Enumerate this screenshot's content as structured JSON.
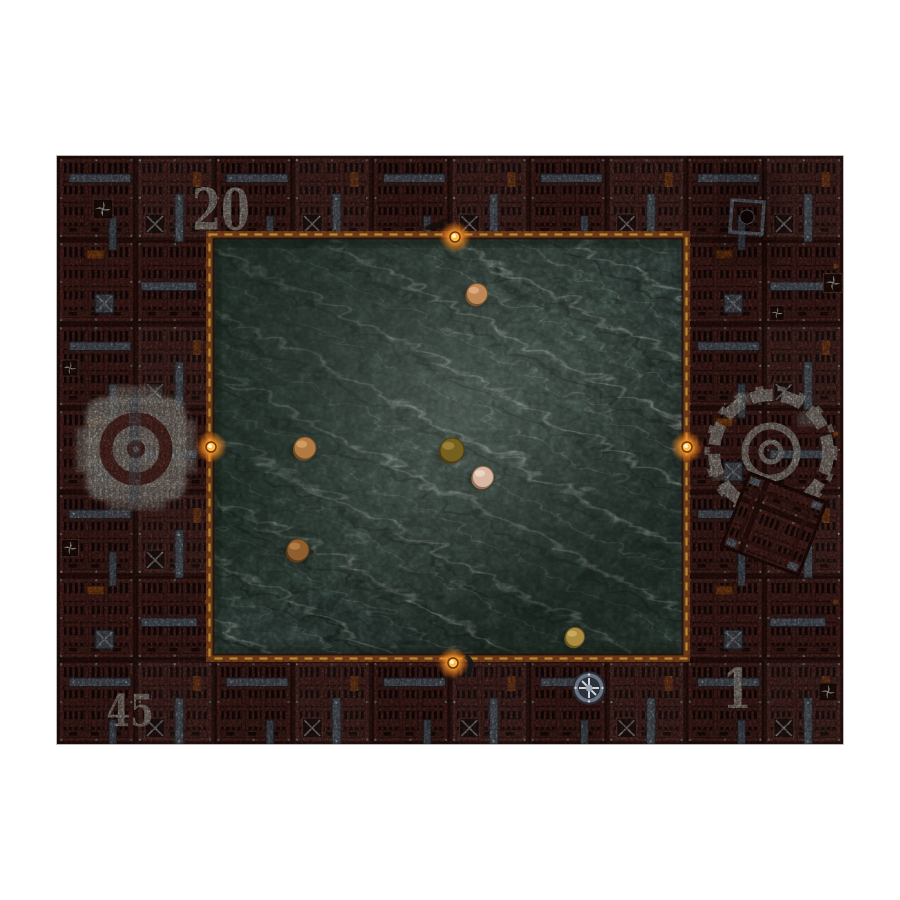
{
  "image": {
    "description": "Top-down product photo of an industrial sci-fi wargaming mat: rust-red grated deck border surrounding a murky teal water pool with round metal disc markers",
    "background_color": "#ffffff"
  },
  "mat": {
    "border": {
      "base_color": "#6d342d",
      "slot_color": "#241010",
      "frame_color": "#3a1713",
      "strap_color": "#8691a0",
      "accent_orange": "#c06320",
      "stencil_color": "#e9e4d8"
    },
    "zone_labels": {
      "top_left": "20",
      "bottom_left": "45",
      "bottom_right": "1"
    }
  },
  "water": {
    "base_color": "#56706a",
    "dark_color": "#37493f",
    "streak_color": "#dfe9df",
    "trim_color": "#6f3a18",
    "hazard_dash_color": "#c89d38"
  },
  "lamps": [
    {
      "name": "hazard-lamp",
      "x": 455,
      "y": 237
    },
    {
      "name": "hazard-lamp",
      "x": 211,
      "y": 447
    },
    {
      "name": "hazard-lamp",
      "x": 687,
      "y": 447
    },
    {
      "name": "hazard-lamp",
      "x": 453,
      "y": 663
    }
  ],
  "coins": [
    {
      "name": "coin-marker",
      "x": 477,
      "y": 294,
      "r": 10.5,
      "face": "#bd8856",
      "hi": "#e3b488",
      "rim": "#7a5230"
    },
    {
      "name": "coin-marker",
      "x": 305,
      "y": 448,
      "r": 11,
      "face": "#b07a42",
      "hi": "#d9a86b",
      "rim": "#6f4a24"
    },
    {
      "name": "coin-marker",
      "x": 452,
      "y": 450,
      "r": 12,
      "face": "#75601f",
      "hi": "#a58a42",
      "rim": "#4f3c14"
    },
    {
      "name": "coin-marker",
      "x": 483,
      "y": 477,
      "r": 10.5,
      "face": "#d8b8a4",
      "hi": "#f0ddcc",
      "rim": "#9a6f54"
    },
    {
      "name": "coin-marker",
      "x": 298,
      "y": 550,
      "r": 11,
      "face": "#8f5e2e",
      "hi": "#b8854a",
      "rim": "#5a3a18"
    },
    {
      "name": "coin-marker",
      "x": 575,
      "y": 637,
      "r": 9.5,
      "face": "#a98a3e",
      "hi": "#cfb468",
      "rim": "#6b5520"
    }
  ],
  "icons": {
    "cog-marking": "white stenciled machine-cog ring",
    "pinwheel-vent": "small square vent with white fan blades",
    "fan-emblem": "circular gray fan grille",
    "hazard-lamp": "orange warning lamp",
    "coin-marker": "round metal disc marker",
    "loose-grate-panel": "tilted square grate panel",
    "access-panel": "rectangular access hatch",
    "crow-silhouette": "dark bird silhouette",
    "chain-hook": "dark hanging hook"
  }
}
